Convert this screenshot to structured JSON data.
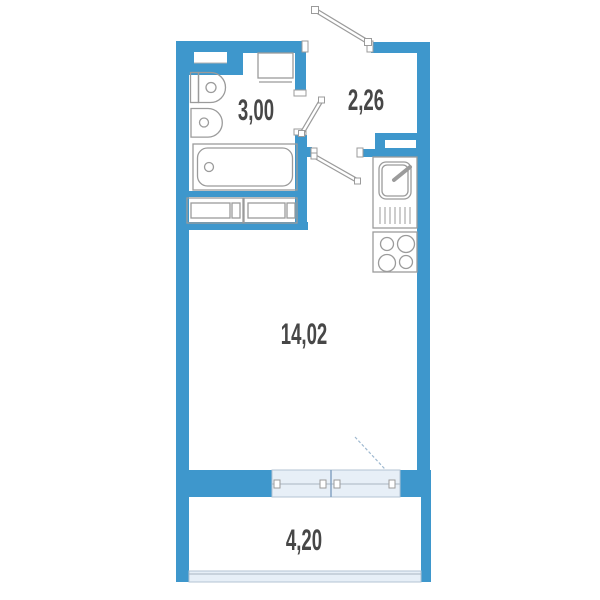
{
  "title": "Studio apartment floor plan",
  "rooms": {
    "bathroom": {
      "name": "bathroom",
      "area": "3,00"
    },
    "hallway": {
      "name": "hallway",
      "area": "2,26"
    },
    "living_room": {
      "name": "living-room",
      "area": "14,02"
    },
    "balcony": {
      "name": "balcony",
      "area": "4,20"
    }
  },
  "colors": {
    "wall": "#3e97cc",
    "glazing_fill": "#e7eff7",
    "glazing_border": "#b3c3d3",
    "fixture_outline": "#9b9b9b",
    "label_text": "#474747",
    "background": "#ffffff"
  },
  "fixtures": [
    "toilet",
    "washbasin",
    "bathtub",
    "washing-machine",
    "built-in-wardrobe",
    "kitchen-sink",
    "kitchen-stove",
    "ventilation-shaft",
    "wall-niche"
  ],
  "doors": [
    "entrance-door",
    "bathroom-door",
    "kitchen-door",
    "balcony-door"
  ],
  "windows": [
    "living-room-window",
    "balcony-glazing"
  ]
}
